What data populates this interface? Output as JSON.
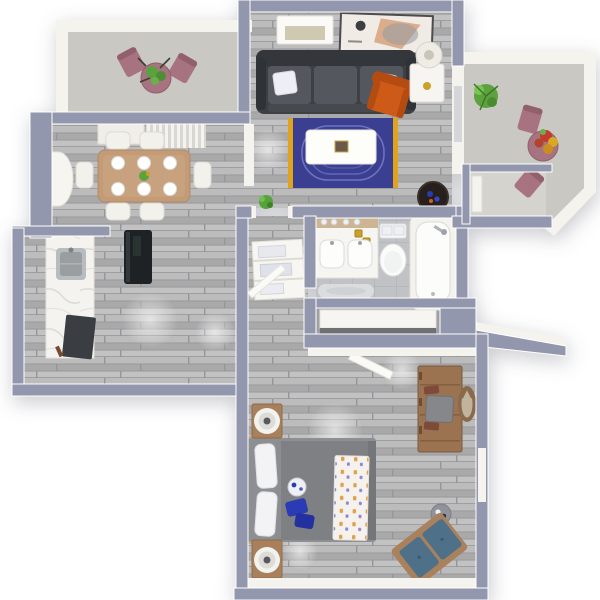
{
  "scene": {
    "kind": "3d-floor-plan-render",
    "view": "top-down",
    "unit": "one-bedroom-apartment"
  },
  "palette": {
    "wall_cap": "#9297ae",
    "wall_white": "#f4f3ee",
    "floor_wood_base": "#b2b2b3",
    "floor_tile": "#c0c2c5",
    "floor_concrete": "#c9c8c2",
    "alcove_concrete": "#d4d3cd",
    "closet_floor": "#9fa0a3",
    "sofa": "#3d4045",
    "sofa_cushion": "#54575d",
    "accent_chair": "#cd5a17",
    "rug": "#3b3f91",
    "rug_border": "#dfa31e",
    "coffee_table": "#fdfdfa",
    "bed_comforter": "#7e8084",
    "blue_accent": "#2b3bb3",
    "throw_orange": "#e2a04a",
    "throw_purple": "#9187ce",
    "dining_wood": "#c39b77",
    "nightstand_wood": "#a8805c",
    "dresser_wood": "#9b7351",
    "bench_teal": "#4e7089",
    "bench_wood": "#a9825d",
    "mauve_chair": "#a87380",
    "plant_green": "#5aa23e",
    "croton_red": "#c23b2e",
    "croton_yellow": "#d9a824",
    "appliance_dark": "#1f2225",
    "brass_gold": "#c9a227",
    "mirror_wood": "#8a6a4c"
  },
  "rooms": {
    "living_room": {
      "label": "living-room",
      "furniture": [
        "sofa-charcoal",
        "throw-pillows-white",
        "accent-chair-orange",
        "side-table-white",
        "table-lamp",
        "media-console",
        "wall-art-frame",
        "area-rug-navy",
        "coffee-table-white",
        "floor-planter-dark",
        "small-green-plant"
      ]
    },
    "dining_room": {
      "label": "dining-room",
      "furniture": [
        "dining-table-wood",
        "dining-chairs-white-x6",
        "place-settings-x6",
        "centerpiece",
        "vertical-blinds",
        "arch-niche"
      ]
    },
    "kitchen": {
      "label": "kitchen",
      "furniture": [
        "marble-counter",
        "kitchen-sink",
        "dark-appliance",
        "refrigerator-black"
      ]
    },
    "bathroom": {
      "label": "bathroom",
      "furniture": [
        "double-vanity",
        "vanity-shelf-glasses",
        "toilet",
        "towels-on-tank",
        "bathtub",
        "bath-mat"
      ]
    },
    "corridor": {
      "label": "hallway",
      "furniture": [
        "linen-shelf-towels",
        "open-door"
      ]
    },
    "closet": {
      "label": "closet",
      "furniture": [
        "closet-shelf"
      ]
    },
    "bedroom": {
      "label": "bedroom",
      "furniture": [
        "bed-gray-comforter",
        "pillows-white",
        "patterned-throw-blanket",
        "blue-pillows",
        "breakfast-tray",
        "nightstand-north",
        "nightstand-south",
        "speaker-round-x2",
        "dresser-desk-wood",
        "desk-chair-gray",
        "round-mirror",
        "side-table-round",
        "bench-teal",
        "window-sill-east",
        "bedroom-door-open"
      ]
    },
    "balcony_left": {
      "label": "patio-north-west",
      "furniture": [
        "mauve-chairs-x2",
        "round-table-mauve",
        "potted-plant-green"
      ]
    },
    "balcony_right": {
      "label": "patio-east",
      "furniture": [
        "fern-plant",
        "mauve-chairs-x2",
        "round-table-mauve",
        "croton-plant-colorful"
      ]
    },
    "entry": {
      "label": "entry-alcove",
      "furniture": [
        "front-door-white"
      ]
    }
  }
}
